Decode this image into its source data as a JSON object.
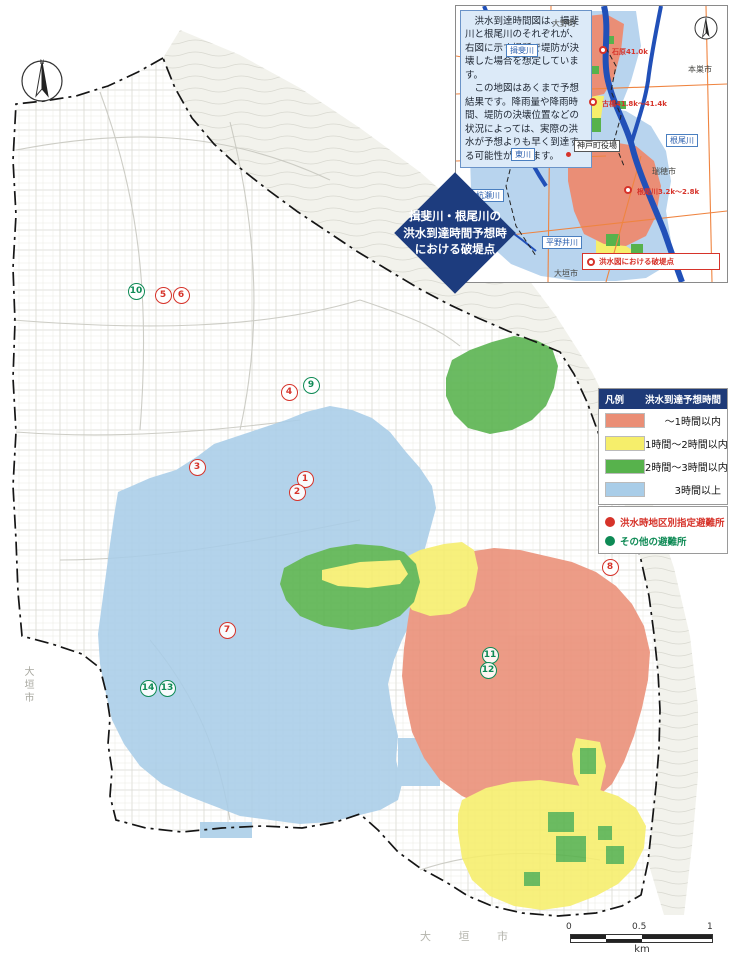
{
  "colors": {
    "zone_1h": "#ea8e76",
    "zone_2h": "#f6ee6b",
    "zone_3h": "#57b24c",
    "zone_over3h": "#a9cde8",
    "navy": "#1d3c7e",
    "red_accent": "#d6332a",
    "green_accent": "#0e8a55"
  },
  "inset": {
    "note": {
      "p1": "　洪水到達時間図は、揖斐川と根尾川のそれぞれが、右図に示す場所で堤防が決壊した場合を想定しています。",
      "p2": "　この地図はあくまで予想結果です。降雨量や降雨時間、堤防の決壊位置などの状況によっては、実際の洪水が予想よりも早く到達する可能性があります。"
    },
    "place_labels": [
      {
        "text": "大野町",
        "type": "plain",
        "x": 96,
        "y": 12
      },
      {
        "text": "本巣市",
        "type": "plain",
        "x": 232,
        "y": 58
      },
      {
        "text": "瑞穂市",
        "type": "plain",
        "x": 196,
        "y": 160
      },
      {
        "text": "大垣市",
        "type": "plain",
        "x": 98,
        "y": 262
      },
      {
        "text": "揖斐川",
        "type": "river",
        "x": 50,
        "y": 38
      },
      {
        "text": "東川",
        "type": "river",
        "x": 55,
        "y": 142
      },
      {
        "text": "杭瀬川",
        "type": "river",
        "x": 16,
        "y": 183
      },
      {
        "text": "根尾川",
        "type": "river",
        "x": 210,
        "y": 128
      },
      {
        "text": "平野井川",
        "type": "river",
        "x": 86,
        "y": 230
      },
      {
        "text": "神戸町役場",
        "type": "office",
        "x": 118,
        "y": 134
      }
    ],
    "office_dot": {
      "x": 110,
      "y": 146
    },
    "breach_points": [
      {
        "label": "石原41.0k",
        "dx": 147,
        "dy": 44,
        "lx": 156,
        "ly": 41
      },
      {
        "label": "古橋41.8k〜41.4k",
        "dx": 137,
        "dy": 96,
        "lx": 146,
        "ly": 93
      },
      {
        "label": "根尾川3.2k〜2.8k",
        "dx": 172,
        "dy": 184,
        "lx": 181,
        "ly": 181
      }
    ],
    "legend_label": "洪水図における破堤点"
  },
  "diamond": {
    "line1": "揖斐川・根尾川の",
    "line2": "洪水到達時間予想時",
    "line3": "における破堤点"
  },
  "legend": {
    "header_left": "凡例",
    "header_right": "洪水到達予想時間",
    "rows": [
      {
        "color": "#ea8e76",
        "label": "～1時間以内"
      },
      {
        "color": "#f6ee6b",
        "label": "1時間～2時間以内"
      },
      {
        "color": "#57b24c",
        "label": "2時間～3時間以内"
      },
      {
        "color": "#a9cde8",
        "label": "3時間以上"
      }
    ],
    "shelters": [
      {
        "color": "#d6332a",
        "label": "洪水時地区別指定避難所"
      },
      {
        "color": "#0e8a55",
        "label": "その他の避難所"
      }
    ]
  },
  "markers": [
    {
      "n": "10",
      "type": "green",
      "x": 136,
      "y": 291
    },
    {
      "n": "5",
      "type": "red",
      "x": 163,
      "y": 295
    },
    {
      "n": "6",
      "type": "red",
      "x": 181,
      "y": 295
    },
    {
      "n": "9",
      "type": "green",
      "x": 311,
      "y": 385
    },
    {
      "n": "4",
      "type": "red",
      "x": 289,
      "y": 392
    },
    {
      "n": "3",
      "type": "red",
      "x": 197,
      "y": 467
    },
    {
      "n": "1",
      "type": "red",
      "x": 305,
      "y": 479
    },
    {
      "n": "2",
      "type": "red",
      "x": 297,
      "y": 492
    },
    {
      "n": "8",
      "type": "red",
      "x": 610,
      "y": 567
    },
    {
      "n": "7",
      "type": "red",
      "x": 227,
      "y": 630
    },
    {
      "n": "11",
      "type": "green",
      "x": 490,
      "y": 655
    },
    {
      "n": "12",
      "type": "green",
      "x": 488,
      "y": 670
    },
    {
      "n": "14",
      "type": "green",
      "x": 148,
      "y": 688
    },
    {
      "n": "13",
      "type": "green",
      "x": 167,
      "y": 688
    }
  ],
  "map_labels": {
    "city_left": "大垣市",
    "city_bottom": "大 垣 市"
  },
  "scalebar": {
    "t0": "0",
    "t05": "0.5",
    "t1": "1",
    "unit": "km"
  }
}
